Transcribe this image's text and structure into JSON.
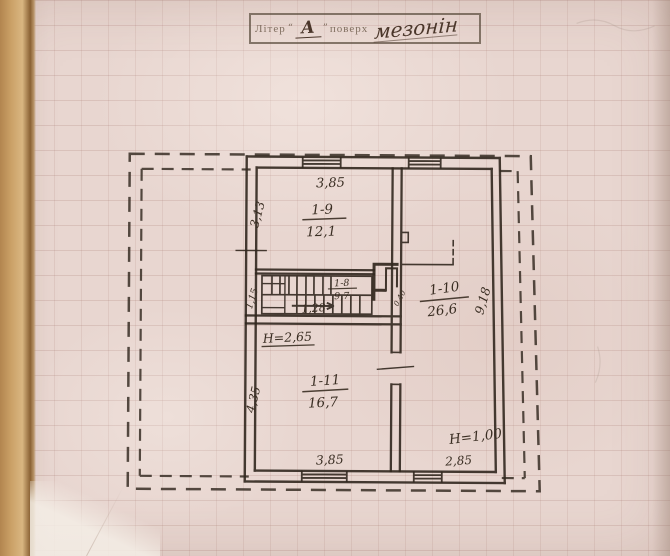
{
  "stamp": {
    "field_label": "Літер",
    "letter": "А",
    "floor_label": "поверх",
    "floor_value": "мезонін"
  },
  "rooms": [
    {
      "number": "1-9",
      "area": "12,1"
    },
    {
      "number": "1-8",
      "area": "9,7"
    },
    {
      "number": "1-10",
      "area": "26,6"
    },
    {
      "number": "1-11",
      "area": "16,7"
    }
  ],
  "dims": {
    "room19_top": "3,85",
    "room19_left": "3,13",
    "stair_width": "1,15",
    "stair_run": "1,28",
    "flue_opening": "0,40",
    "room110_right": "9,18",
    "room110_bottom": "2,85",
    "room111_left": "4,35",
    "room111_bottom": "3,85"
  },
  "heights": {
    "room111": "H=2,65",
    "room110": "H=1,00"
  },
  "colors": {
    "ink": "#32281f",
    "paper": "#e8d6d0",
    "grid": "#a57870",
    "book_edge": "#caa066",
    "stamp_ink": "#766454",
    "hand_ink": "#4a362a"
  }
}
